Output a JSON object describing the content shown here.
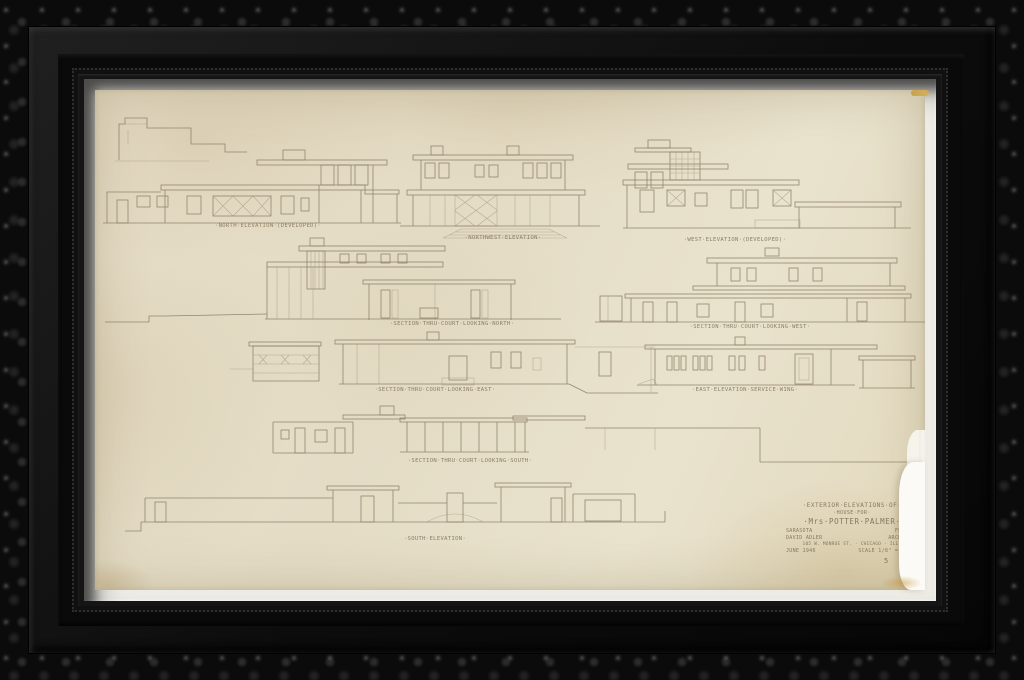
{
  "artwork": {
    "kind": "framed architectural elevation drawing",
    "colors": {
      "frame_black": "#0b0b0b",
      "liner_silver": "#edebe5",
      "paper_cream": "#e8e0ca",
      "pencil_ink": "#8c7f67",
      "stain_yellow": "#c49a3e"
    },
    "labels": {
      "north": "·NORTH·ELEVATION·(DEVELOPED)·",
      "northwest": "·NORTHWEST·ELEVATION·",
      "west": "·WEST·ELEVATION·(DEVELOPED)·",
      "section_north": "·SECTION·THRU·COURT·LOOKING·NORTH·",
      "section_west": "·SECTION·THRU·COURT·LOOKING·WEST·",
      "section_east": "·SECTION·THRU·COURT·LOOKING·EAST·",
      "east_service": "·EAST·ELEVATION·SERVICE·WING·",
      "section_south": "·SECTION·THRU·COURT·LOOKING·SOUTH·",
      "south": "·SOUTH·ELEVATION·"
    },
    "title_block": {
      "line1": "·EXTERIOR·ELEVATIONS·OF·",
      "line2": "·HOUSE·FOR·",
      "line3": "·Mrs·POTTER·PALMER·",
      "line4_left": "SARASOTA",
      "line4_right": "FLORIDA",
      "line5_left": "DAVID ADLER",
      "line5_right": "ARCHITECT",
      "line6": "105 W. MONROE ST. · CHICAGO · ILL.",
      "line7_left": "JUNE 1946",
      "line7_right": "SCALE 1/8\" = 1'-0\"",
      "sheet_no": "5"
    }
  }
}
